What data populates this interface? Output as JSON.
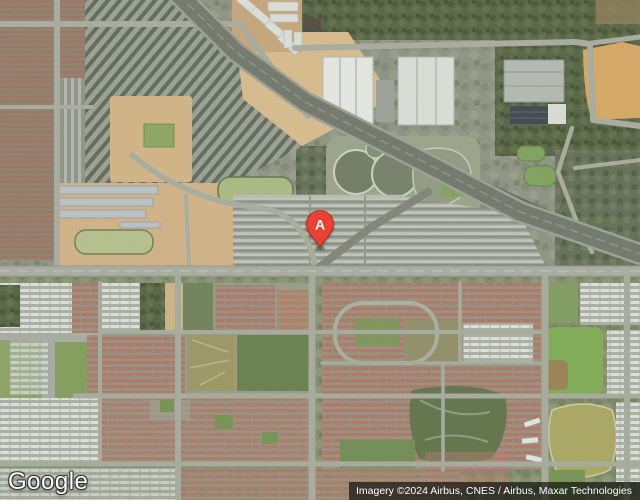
{
  "map": {
    "view_type": "satellite",
    "marker": {
      "label": "A",
      "pin_color": "#E94335",
      "pin_border": "#A8271D",
      "label_color": "#FFFFFF"
    }
  },
  "branding": {
    "logo_text": "Google"
  },
  "attribution": {
    "text": "Imagery ©2024 Airbus, CNES / Airbus, Maxar Technologies"
  },
  "colors": {
    "terrain_base": "#87907b",
    "sand": "#d3b383",
    "orange_field": "#d7a65f",
    "forest": "#51603f",
    "residential_red_roof": "#a06e5c",
    "parking_lot_gray": "#9aa095",
    "pond_light_green": "#aab97e",
    "park_bright_green": "#7cab50",
    "pond_olive": "#a9a65e",
    "road_gray": "#a8aca0",
    "highway_gray": "#6f7468",
    "attribution_bg": "rgba(0,0,0,0.62)"
  }
}
